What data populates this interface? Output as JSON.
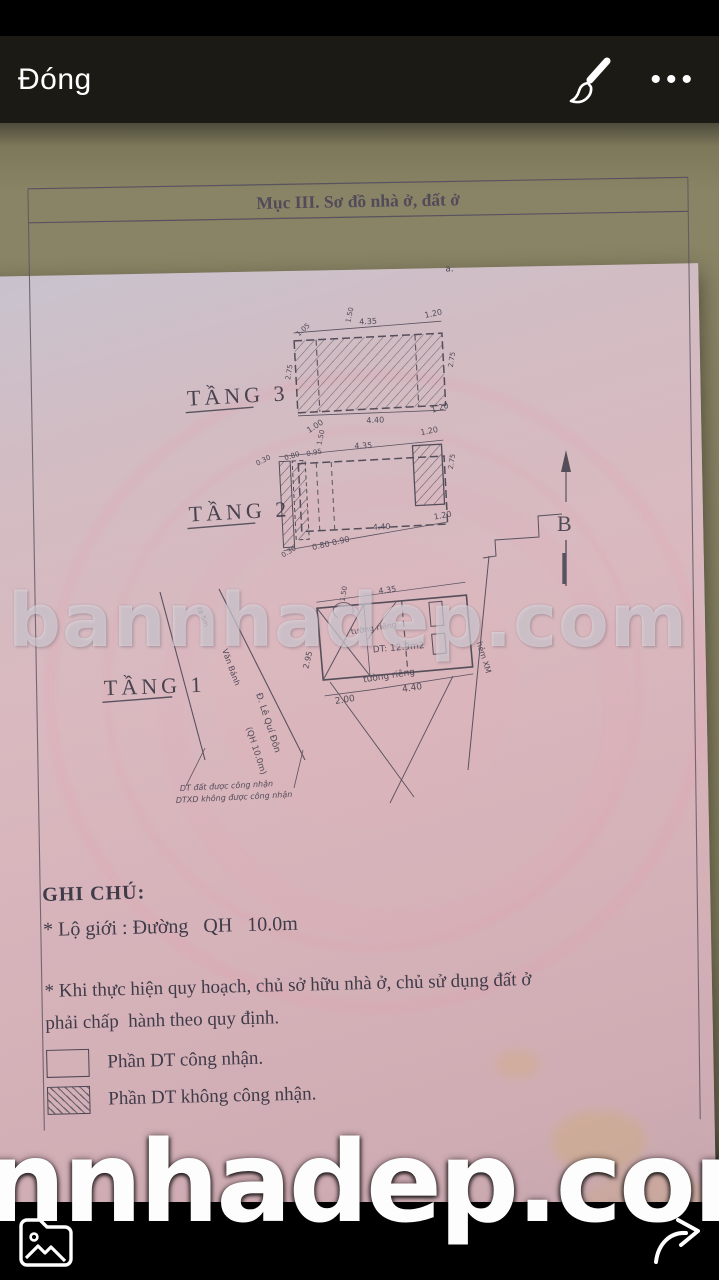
{
  "top_bar": {
    "close": "Đóng"
  },
  "doc": {
    "title": "Mục III. Sơ đồ nhà ở, đất ở",
    "stray": "a.",
    "north": "B",
    "t3": {
      "label": "TẦNG 3",
      "top": [
        "1.05",
        "4.35",
        "1.20"
      ],
      "top_small": "1.50",
      "bottom": [
        "1.00",
        "4.40",
        "1.20"
      ],
      "left": "2.75",
      "right": "2.75"
    },
    "t2": {
      "label": "TẦNG 2",
      "top": [
        "0.30",
        "0.80",
        "0.95",
        "4.35",
        "1.20"
      ],
      "top_small": "1.50",
      "bottom": [
        "0.30",
        "0.80 0.90",
        "4.40",
        "1.20"
      ],
      "right": "2.75"
    },
    "t1": {
      "label": "TẦNG 1",
      "top": "4.35",
      "top_small": "1.50",
      "bottom": [
        "2.00",
        "4.40"
      ],
      "left": "2.95",
      "area": "DT: 12.9m2",
      "wall_top": "tường riêng",
      "wall_bottom": "tường riêng",
      "alley": "hẻm XM",
      "streets": [
        "ra 5m",
        "Văn Bánh",
        "Đ. Lê Quí Đôn",
        "(QH 10.0m)"
      ],
      "notes": [
        "DT đất được công nhận",
        "DTXD không được công nhận"
      ]
    },
    "ghichu": {
      "heading": "GHI CHÚ:",
      "lo_gioi": "* Lộ giới : Đường   QH   10.0m",
      "para": "* Khi thực hiện quy hoạch, chủ sở hữu nhà ở, chủ sử dụng đất ở phải chấp  hành theo quy định.",
      "legend": [
        {
          "label": "Phần DT công nhận."
        },
        {
          "label": "Phần DT không công nhận."
        }
      ]
    }
  },
  "watermark": {
    "mid": "bannhadep.com",
    "bottom": "nnhadep.com"
  }
}
